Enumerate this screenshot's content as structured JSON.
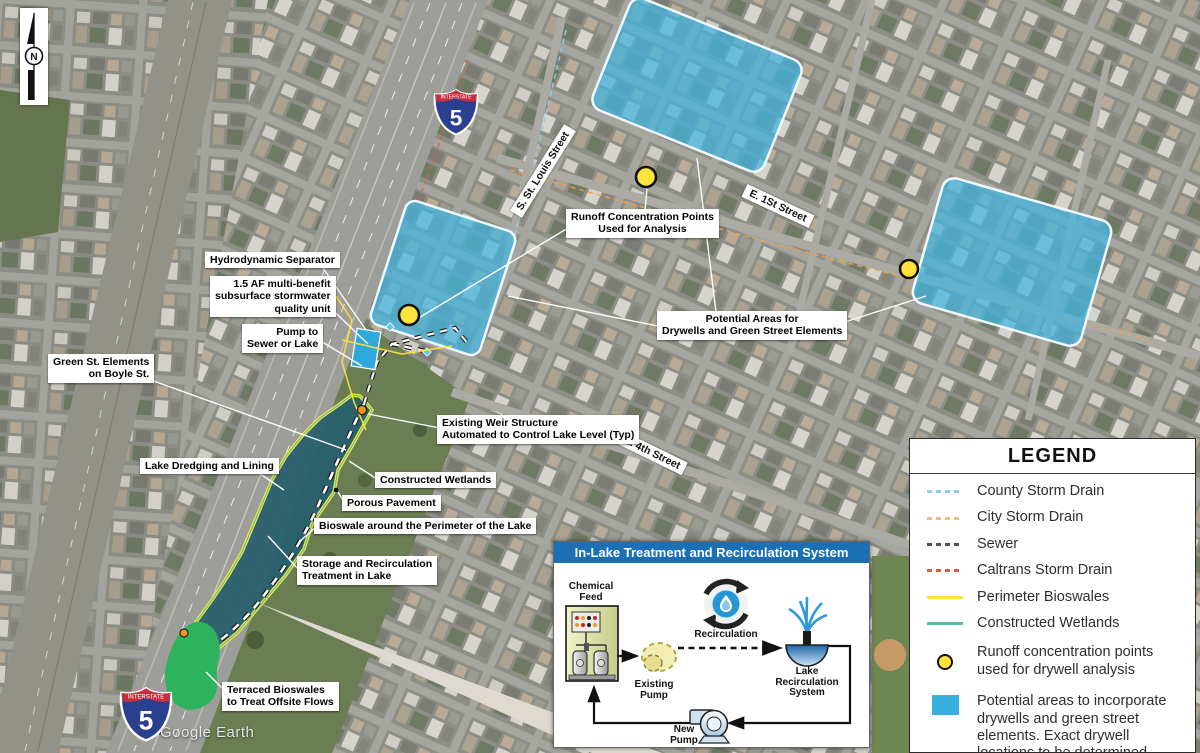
{
  "map": {
    "attribution": "Google Earth",
    "north_label": "N"
  },
  "shield": {
    "interstate_label": "INTERSTATE",
    "route_number": "5"
  },
  "streets": [
    {
      "name": "S. St. Louis Street"
    },
    {
      "name": "E. 1St Street"
    },
    {
      "name": "E. 4th Street"
    }
  ],
  "callouts": [
    {
      "text": "Hydrodynamic Separator"
    },
    {
      "text": "1.5 AF multi-benefit\nsubsurface stormwater\nquality unit"
    },
    {
      "text": "Pump to\nSewer or Lake"
    },
    {
      "text": "Green St. Elements\non Boyle St."
    },
    {
      "text": "Lake Dredging and Lining"
    },
    {
      "text": "Existing Weir Structure\nAutomated to Control Lake Level (Typ)"
    },
    {
      "text": "Constructed Wetlands"
    },
    {
      "text": "Porous Pavement"
    },
    {
      "text": "Bioswale around the Perimeter of the Lake"
    },
    {
      "text": "Storage and Recirculation\nTreatment in Lake"
    },
    {
      "text": "Runoff Concentration Points\nUsed for Analysis"
    },
    {
      "text": "Potential Areas for\nDrywells and Green Street Elements"
    },
    {
      "text": "Terraced Bioswales\nto Treat Offsite Flows"
    }
  ],
  "legend": {
    "title": "LEGEND",
    "items": [
      {
        "label": "County Storm Drain",
        "swatch": "dash",
        "color": "#8ecfe8"
      },
      {
        "label": "City Storm Drain",
        "swatch": "dash",
        "color": "#f4b97e"
      },
      {
        "label": "Sewer",
        "swatch": "dash",
        "color": "#4f4f5c"
      },
      {
        "label": "Caltrans Storm Drain",
        "swatch": "dash",
        "color": "#d95f4a"
      },
      {
        "label": "Perimeter Bioswales",
        "swatch": "solid",
        "color": "#ffe23a"
      },
      {
        "label": "Constructed Wetlands",
        "swatch": "solid",
        "color": "#52bfa5"
      },
      {
        "label": "Runoff concentration points\nused for drywell analysis",
        "swatch": "dot",
        "color": "#ffe23a"
      },
      {
        "label": "Potential areas to incorporate\ndrywells and green street\nelements. Exact drywell\nlocations to be determined\nat design phase.",
        "swatch": "square",
        "color": "#35b0dd"
      }
    ]
  },
  "inset": {
    "title": "In-Lake Treatment and Recirculation System",
    "labels": {
      "chemical_feed": "Chemical\nFeed",
      "existing_pump": "Existing\nPump",
      "recirculation": "Recirculation",
      "lake_recirculation_system": "Lake\nRecirculation\nSystem",
      "new_pump": "New\nPump"
    }
  },
  "colors": {
    "drywell_area_fill": "#41b6e0",
    "lake_fill": "#275f6d",
    "perimeter_bioswale": "#ffe23a",
    "constructed_wetland": "#54c2a2",
    "runoff_dot": "#ffe23a",
    "terraced_bioswale": "#2db25e",
    "inset_header": "#1a6fb5"
  }
}
